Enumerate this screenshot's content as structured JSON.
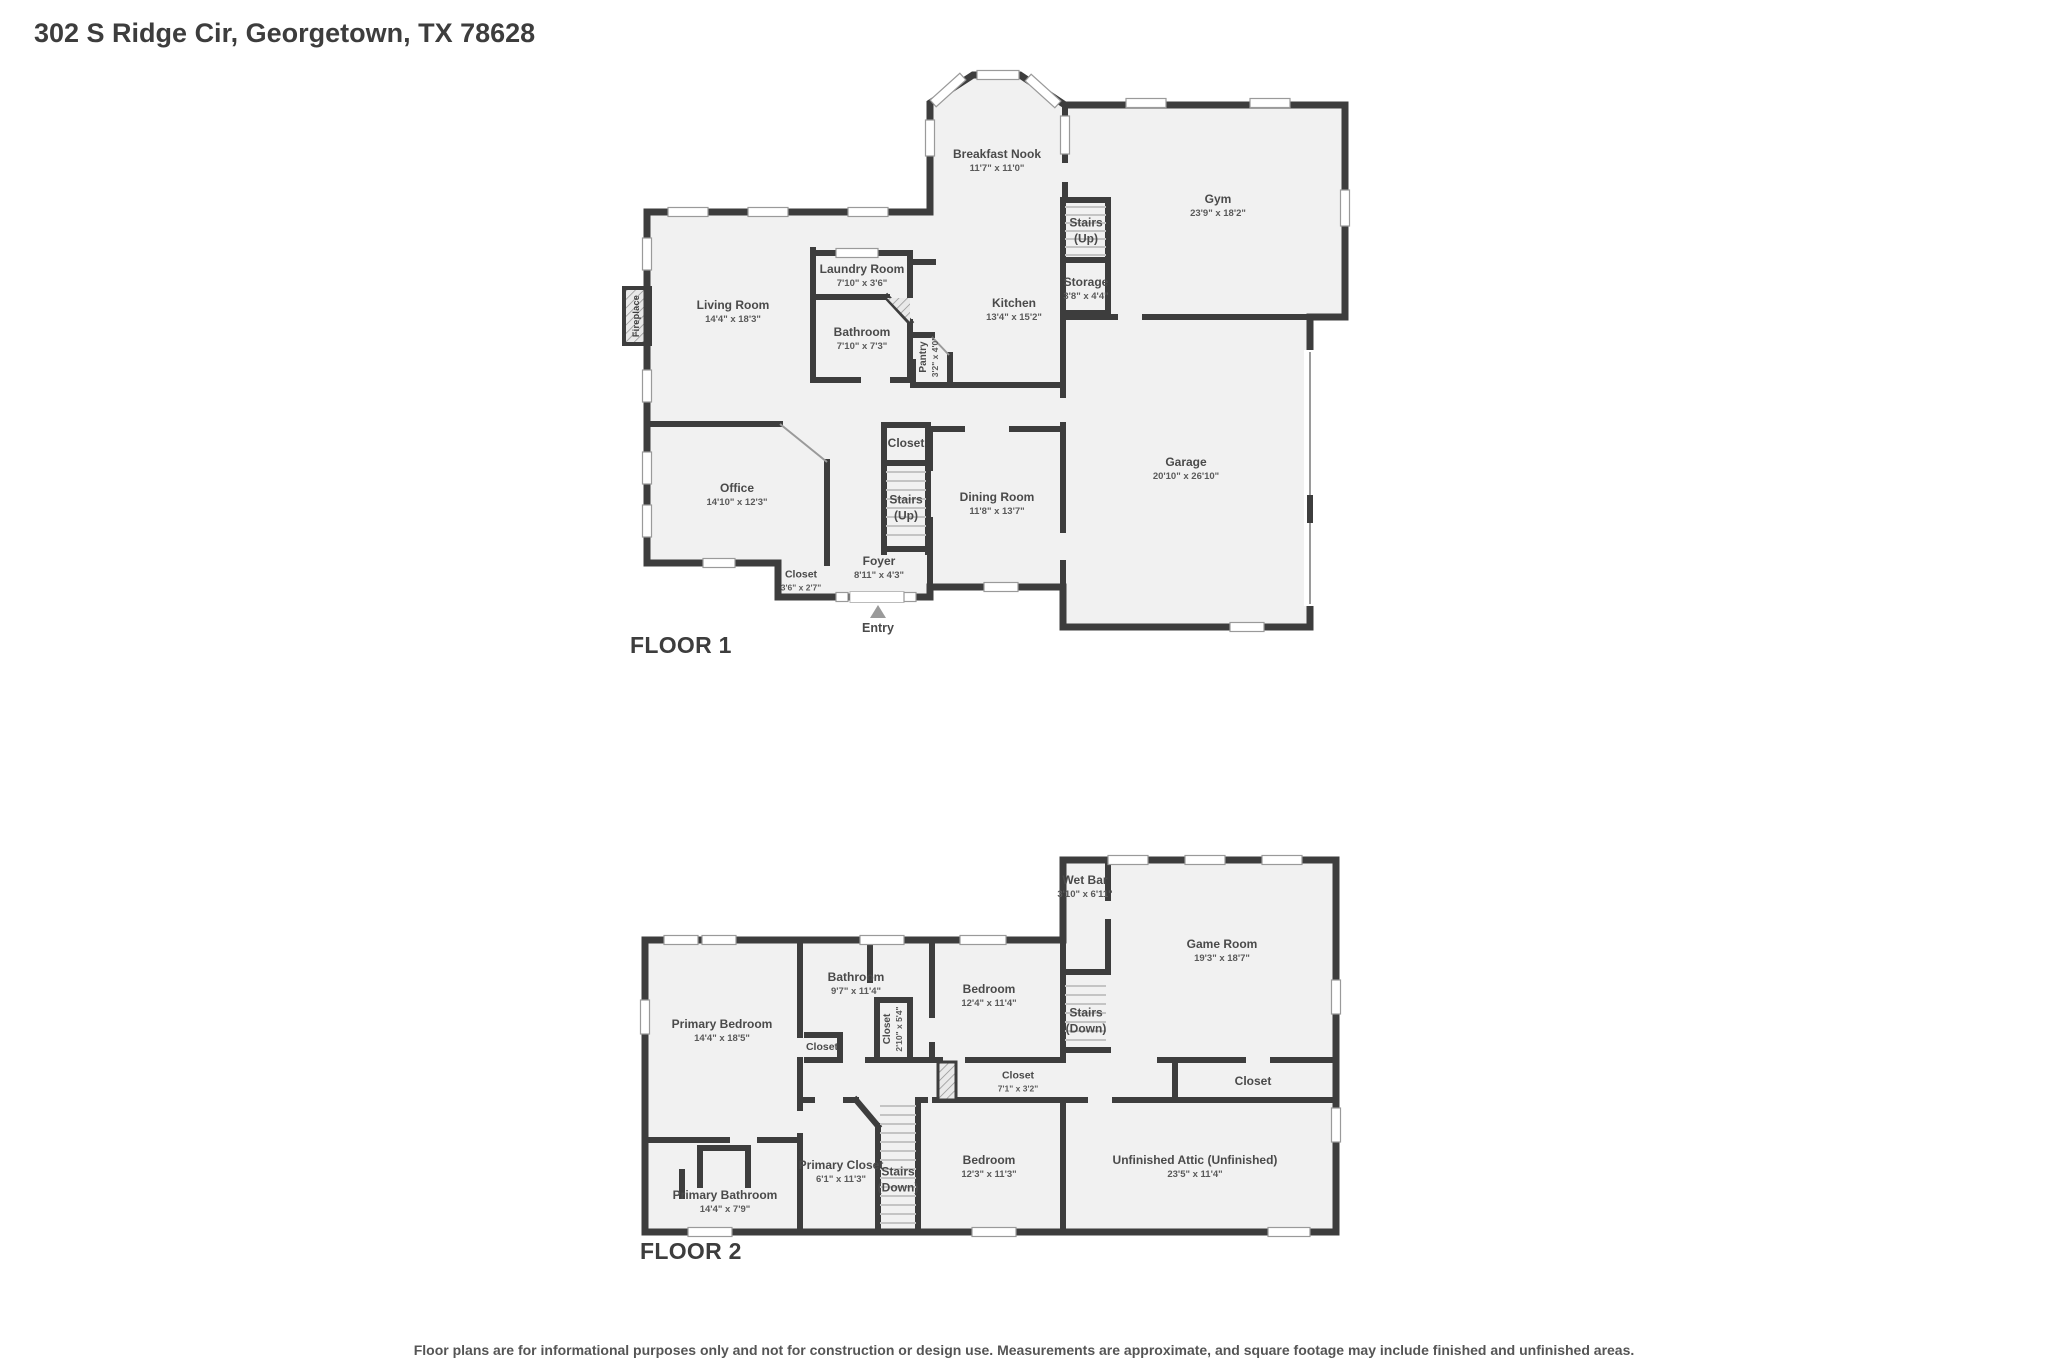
{
  "page": {
    "title": "302 S Ridge Cir, Georgetown, TX 78628",
    "disclaimer": "Floor plans are for informational purposes only and not for construction or design use. Measurements are approximate, and square footage may include finished and unfinished areas."
  },
  "floor1": {
    "title": "FLOOR 1",
    "entry_label": "Entry",
    "fireplace_label": "Fireplace",
    "rooms": [
      {
        "name": "Living Room",
        "dims": "14'4\" x 18'3\""
      },
      {
        "name": "Breakfast Nook",
        "dims": "11'7\" x 11'0\""
      },
      {
        "name": "Gym",
        "dims": "23'9\" x 18'2\""
      },
      {
        "name": "Stairs",
        "sub": "(Up)"
      },
      {
        "name": "Storage",
        "dims": "3'8\" x 4'4\""
      },
      {
        "name": "Laundry Room",
        "dims": "7'10\" x 3'6\""
      },
      {
        "name": "Kitchen",
        "dims": "13'4\" x 15'2\""
      },
      {
        "name": "Bathroom",
        "dims": "7'10\" x 7'3\""
      },
      {
        "name": "Pantry",
        "dims": "3'2\" x 4'0\""
      },
      {
        "name": "Office",
        "dims": "14'10\" x 12'3\""
      },
      {
        "name": "Closet"
      },
      {
        "name": "Stairs",
        "sub": "(Up)"
      },
      {
        "name": "Dining Room",
        "dims": "11'8\" x 13'7\""
      },
      {
        "name": "Garage",
        "dims": "20'10\" x 26'10\""
      },
      {
        "name": "Foyer",
        "dims": "8'11\" x 4'3\""
      },
      {
        "name": "Closet",
        "dims": "3'6\" x 2'7\""
      }
    ]
  },
  "floor2": {
    "title": "FLOOR 2",
    "rooms": [
      {
        "name": "Primary Bedroom",
        "dims": "14'4\" x 18'5\""
      },
      {
        "name": "Wet Bar",
        "dims": "3'10\" x 6'11\""
      },
      {
        "name": "Game Room",
        "dims": "19'3\" x 18'7\""
      },
      {
        "name": "Stairs",
        "sub": "(Down)"
      },
      {
        "name": "Bathroom",
        "dims": "9'7\" x 11'4\""
      },
      {
        "name": "Bedroom",
        "dims": "12'4\" x 11'4\""
      },
      {
        "name": "Closet",
        "dims": "2'10\" x 5'4\""
      },
      {
        "name": "Closet"
      },
      {
        "name": "Closet",
        "dims": "7'1\" x 3'2\""
      },
      {
        "name": "Closet"
      },
      {
        "name": "Primary Closet",
        "dims": "6'1\" x 11'3\""
      },
      {
        "name": "Stairs",
        "sub": "(Down)"
      },
      {
        "name": "Bedroom",
        "dims": "12'3\" x 11'3\""
      },
      {
        "name": "Unfinished Attic (Unfinished)",
        "dims": "23'5\" x 11'4\""
      },
      {
        "name": "Primary Bathroom",
        "dims": "14'4\" x 7'9\""
      }
    ]
  }
}
